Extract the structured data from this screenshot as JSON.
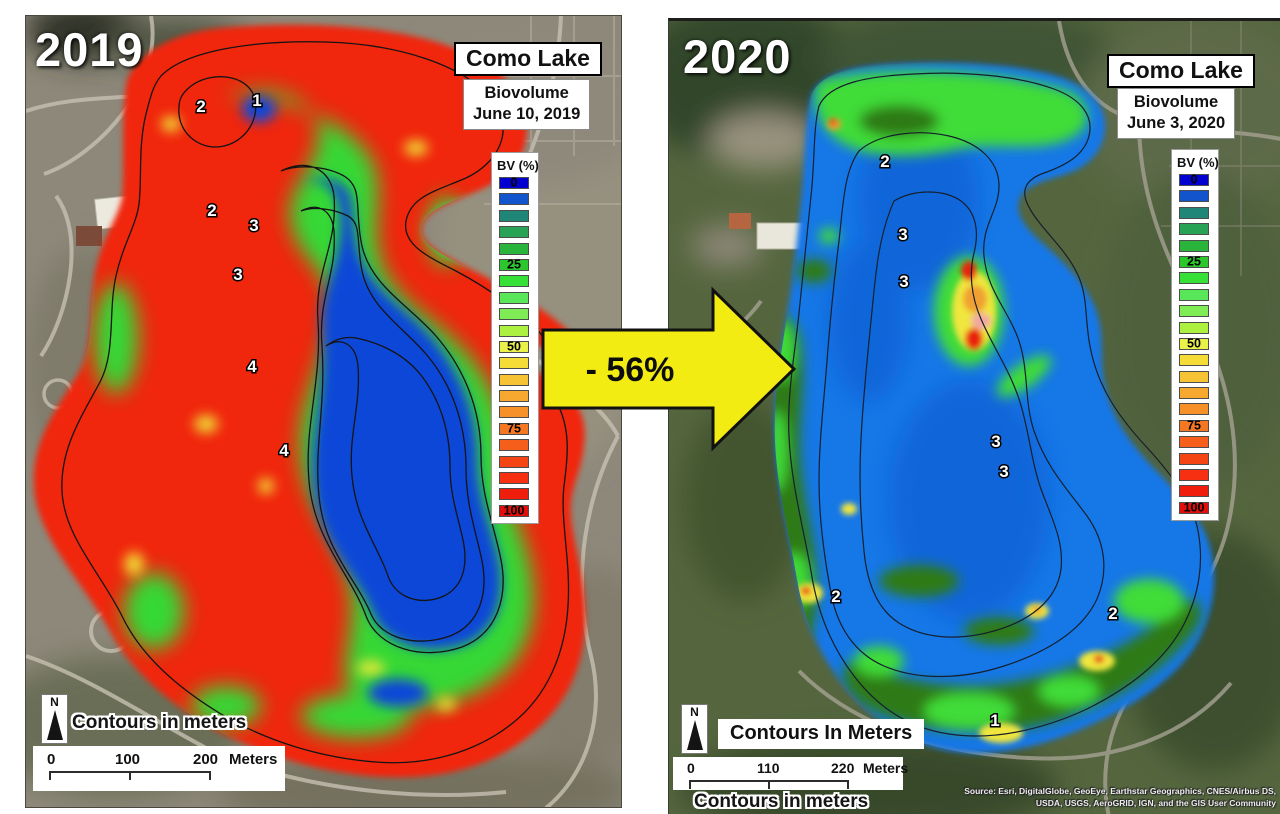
{
  "legend": {
    "title": "BV (%)",
    "colors": [
      "#0201CF",
      "#1254CB",
      "#1F8678",
      "#28A355",
      "#2BB43C",
      "#2CC72C",
      "#36E036",
      "#59E659",
      "#80EC55",
      "#ACF13F",
      "#EAF24A",
      "#F6DC36",
      "#F6C334",
      "#F6A92E",
      "#F69028",
      "#F67722",
      "#F65E1B",
      "#F64515",
      "#F63010",
      "#F11D0C",
      "#E30E0B"
    ],
    "labels": [
      {
        "index": 0,
        "text": "0"
      },
      {
        "index": 5,
        "text": "25"
      },
      {
        "index": 10,
        "text": "50"
      },
      {
        "index": 15,
        "text": "75"
      },
      {
        "index": 20,
        "text": "100"
      }
    ]
  },
  "panels": {
    "left": {
      "year": "2019",
      "title": "Como Lake",
      "subtitle": "Biovolume",
      "date": "June 10, 2019",
      "north": "N",
      "contours_note": "Contours in meters",
      "scale": {
        "t0": "0",
        "t1": "100",
        "t2": "200",
        "unit": "Meters"
      },
      "contour_labels": [
        {
          "text": "2",
          "x": 175,
          "y": 96
        },
        {
          "text": "1",
          "x": 231,
          "y": 90
        },
        {
          "text": "2",
          "x": 186,
          "y": 200
        },
        {
          "text": "3",
          "x": 228,
          "y": 215
        },
        {
          "text": "3",
          "x": 212,
          "y": 264
        },
        {
          "text": "4",
          "x": 226,
          "y": 356
        },
        {
          "text": "4",
          "x": 258,
          "y": 440
        }
      ]
    },
    "right": {
      "year": "2020",
      "title": "Como Lake",
      "subtitle": "Biovolume",
      "date": "June 3, 2020",
      "north": "N",
      "contours_box": "Contours In Meters",
      "contours_note": "Contours in meters",
      "scale": {
        "t0": "0",
        "t1": "110",
        "t2": "220",
        "unit": "Meters"
      },
      "contour_labels": [
        {
          "text": "2",
          "x": 216,
          "y": 146
        },
        {
          "text": "3",
          "x": 234,
          "y": 219
        },
        {
          "text": "3",
          "x": 235,
          "y": 266
        },
        {
          "text": "3",
          "x": 327,
          "y": 426
        },
        {
          "text": "3",
          "x": 335,
          "y": 456
        },
        {
          "text": "2",
          "x": 167,
          "y": 581
        },
        {
          "text": "2",
          "x": 444,
          "y": 598
        },
        {
          "text": "1",
          "x": 326,
          "y": 705
        }
      ],
      "source_line1": "Source: Esri, DigitalGlobe, GeoEye, Earthstar Geographics, CNES/Airbus DS,",
      "source_line2": "USDA, USGS, AeroGRID, IGN, and the GIS User Community"
    }
  },
  "arrow": {
    "label": "- 56%",
    "color": "#F3EC13"
  },
  "colors": {
    "bv_high_red": "#F0260F",
    "bv_mid_green": "#35D835",
    "bv_low_blue": "#0A46D8",
    "lake_2020_blue": "#1777E7",
    "shore_dark_green_2020": "#2E7A18",
    "shore_bright_green_2020": "#41DC38"
  }
}
